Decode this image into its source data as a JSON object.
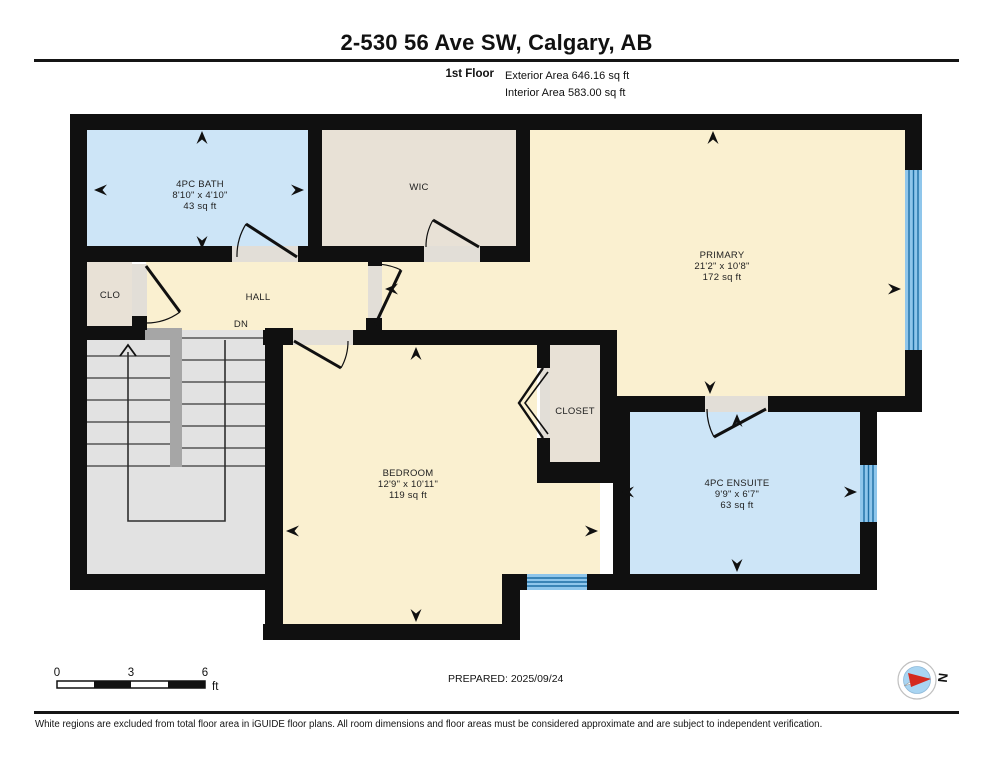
{
  "header": {
    "title": "2-530 56 Ave SW, Calgary, AB",
    "floor_label": "1st Floor",
    "exterior_area": "Exterior Area 646.16 sq ft",
    "interior_area": "Interior Area 583.00 sq ft"
  },
  "rooms": {
    "bath": {
      "name": "4PC BATH",
      "dims": "8'10\" x 4'10\"",
      "area": "43 sq ft"
    },
    "wic": {
      "name": "WIC"
    },
    "primary": {
      "name": "PRIMARY",
      "dims": "21'2\" x 10'8\"",
      "area": "172 sq ft"
    },
    "clo": {
      "name": "CLO"
    },
    "hall": {
      "name": "HALL",
      "stairs_label": "DN"
    },
    "bedroom": {
      "name": "BEDROOM",
      "dims": "12'9\" x 10'11\"",
      "area": "119 sq ft"
    },
    "closet": {
      "name": "CLOSET"
    },
    "ensuite": {
      "name": "4PC ENSUITE",
      "dims": "9'9\" x 6'7\"",
      "area": "63 sq ft"
    }
  },
  "scale_bar": {
    "start": "0",
    "mid": "3",
    "end": "6",
    "unit": "ft"
  },
  "footer": {
    "prepared": "PREPARED: 2025/09/24",
    "compass_label": "N",
    "disclaimer": "White regions are excluded from total floor area in iGUIDE floor plans. All room dimensions and floor areas must be considered approximate and are subject to independent verification."
  },
  "colors": {
    "room_blue": "#cde5f7",
    "room_cream": "#faf0d0",
    "room_beige": "#e8e1d6",
    "stairs_gray": "#e2e2e2",
    "wall_black": "#101010",
    "window_blue": "#8fc6eb",
    "window_line_blue": "#1e6fa5",
    "compass_red": "#d42a1e",
    "compass_blue": "#a9d5f2"
  }
}
